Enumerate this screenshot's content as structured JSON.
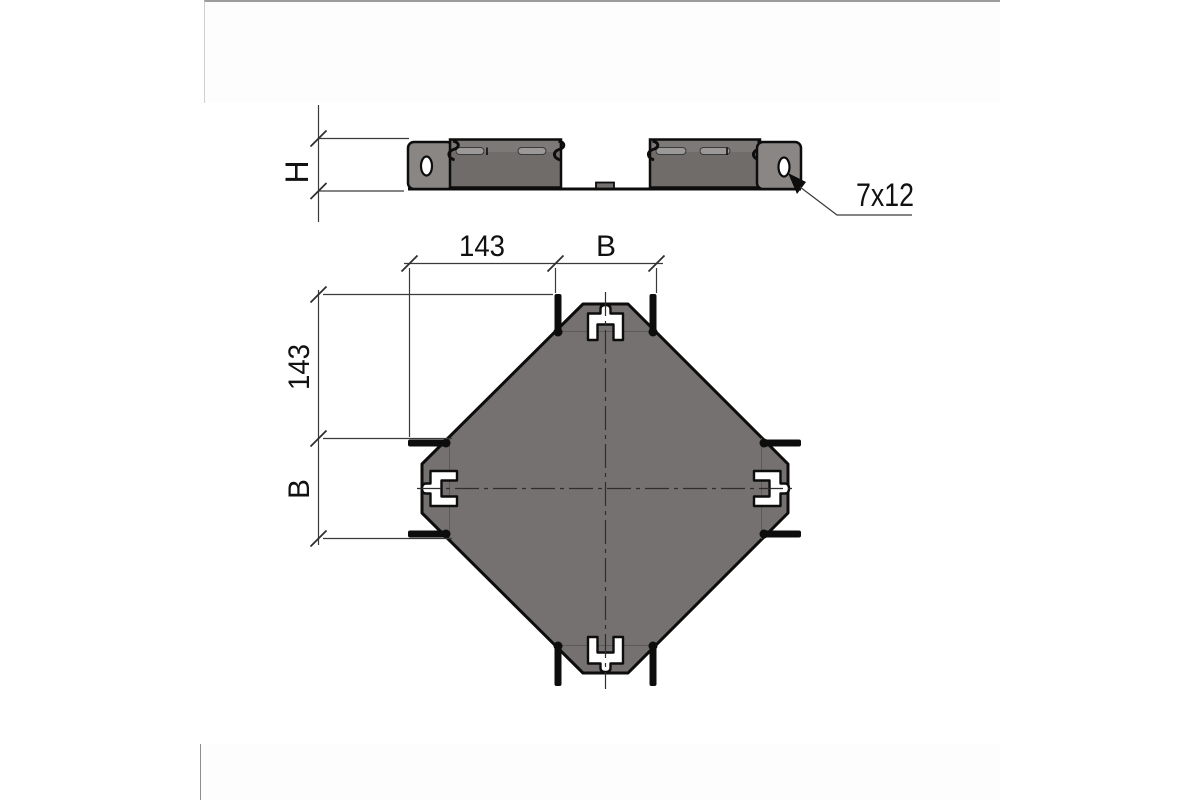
{
  "window": {
    "background": "#ffffff"
  },
  "panels": {
    "top_card": {
      "fill": "#fdfdfd",
      "border_top": "#9c9c9c",
      "border_left": "#cfcfcf"
    },
    "bottom_card": {
      "fill": "#fdfdfd",
      "border_left": "#8e8e8e"
    }
  },
  "drawing": {
    "kind": "cable-tray-cross-piece-technical-drawing",
    "colors": {
      "outline": "#0d0d0d",
      "body_fill": "#757170",
      "wall_fill": "#706c6a",
      "wall_highlight": "#7d7977",
      "flange_fill": "#8a8684",
      "slot_fill": "#9b9997",
      "dim_line": "#3a3a3a",
      "text": "#111111"
    },
    "side_view": {
      "height_dim": {
        "label": "H"
      },
      "hole_callout": {
        "label": "7x12"
      }
    },
    "plan_view": {
      "dim_horizontal": {
        "left": "143",
        "right": "B"
      },
      "dim_vertical": {
        "top": "143",
        "bottom": "B"
      }
    }
  }
}
